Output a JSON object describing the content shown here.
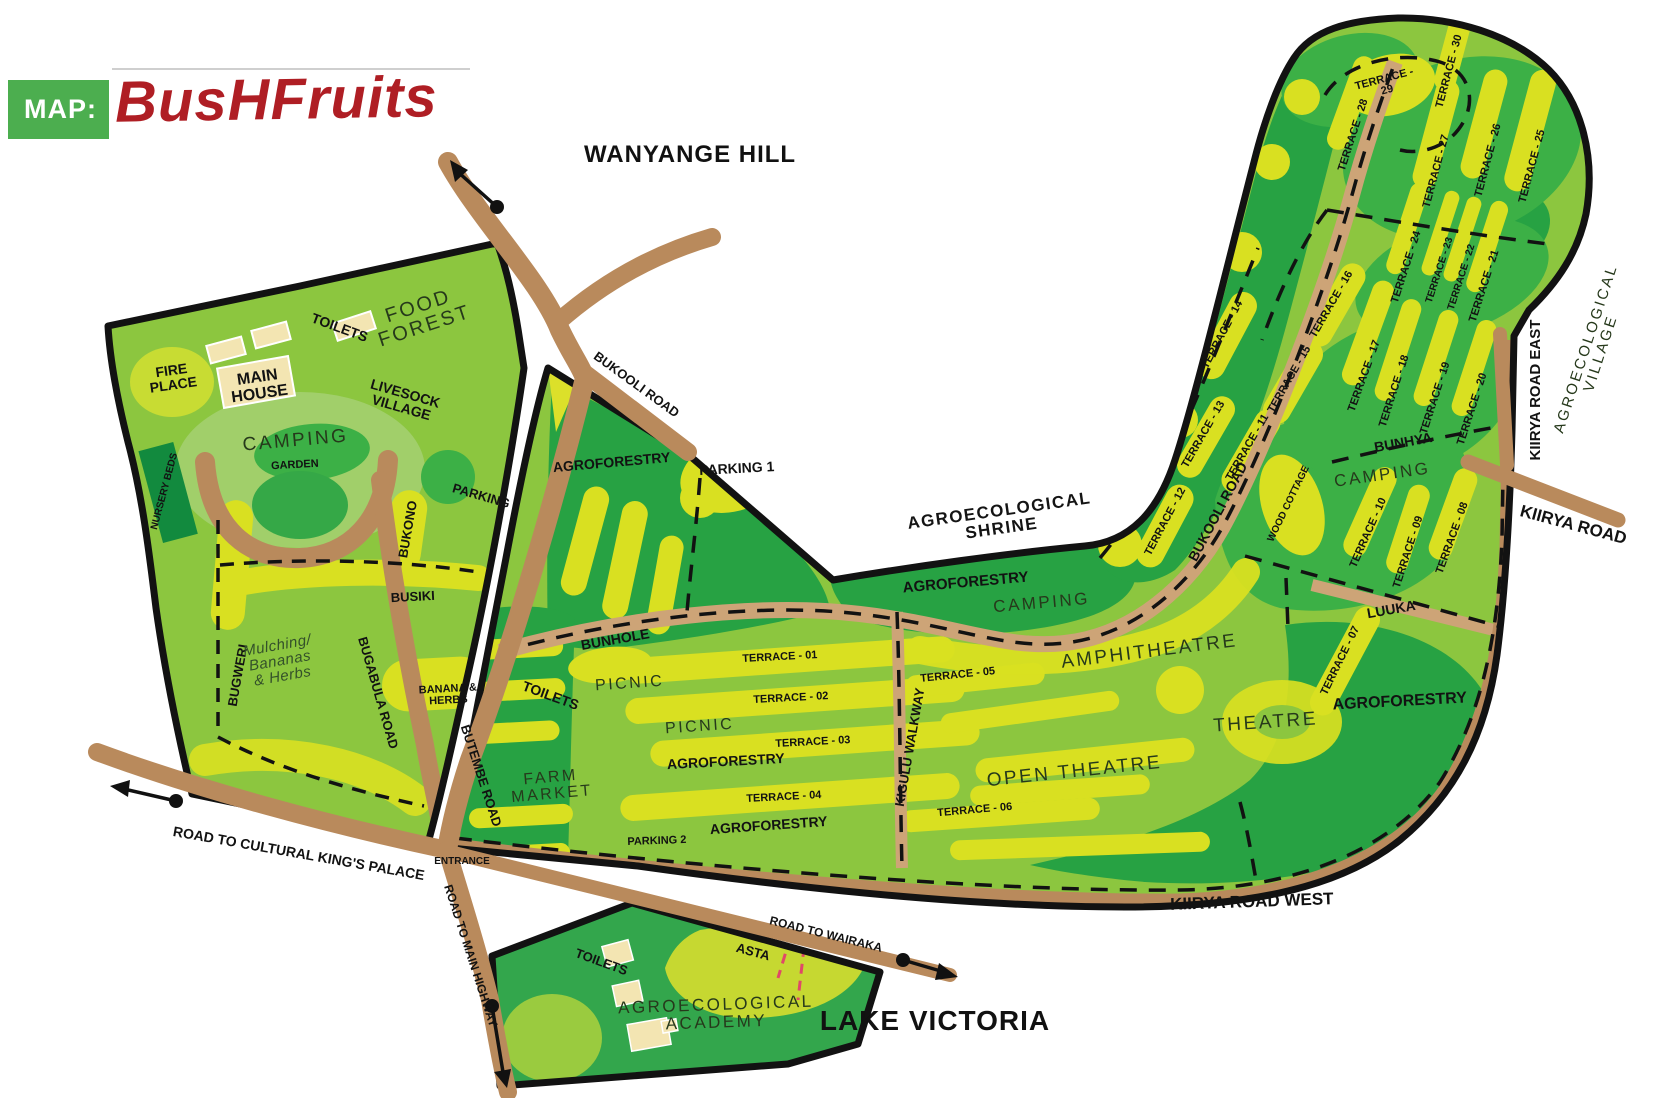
{
  "logo": {
    "map_prefix": "MAP:",
    "title": "BusHFruits"
  },
  "colors": {
    "logo_green": "#4CAE4F",
    "logo_red": "#AF1E24",
    "base_green": "#8CC63F",
    "mid_green": "#3CB046",
    "dark_green": "#27A243",
    "nursery_green": "#128A3E",
    "terrace_yellow": "#D9E021",
    "road_brown": "#B98A5C",
    "trail_tan": "#CDA477",
    "building_cream": "#F3E5B2",
    "outline_black": "#121212",
    "pink_dash": "#E04868"
  },
  "map": {
    "labels": [
      {
        "n": "wanyange-hill",
        "t": "WANYANGE HILL",
        "x": 690,
        "y": 162,
        "r": 0,
        "s": 24,
        "st": "head"
      },
      {
        "n": "lake-victoria",
        "t": "LAKE VICTORIA",
        "x": 935,
        "y": 1030,
        "r": 0,
        "s": 28,
        "st": "head"
      },
      {
        "n": "food-forest",
        "ls": [
          "FOOD",
          "FOREST"
        ],
        "x": 420,
        "y": 312,
        "r": -18,
        "s": 20,
        "st": "light"
      },
      {
        "n": "toilets-left",
        "t": "TOILETS",
        "x": 338,
        "y": 332,
        "r": 20,
        "s": 14,
        "st": "bold"
      },
      {
        "n": "fire-place",
        "ls": [
          "FIRE",
          "PLACE"
        ],
        "x": 172,
        "y": 375,
        "r": -8,
        "s": 14,
        "st": "bold"
      },
      {
        "n": "main-house",
        "ls": [
          "MAIN",
          "HOUSE"
        ],
        "x": 258,
        "y": 382,
        "r": -8,
        "s": 16,
        "st": "bold"
      },
      {
        "n": "livesock-village",
        "ls": [
          "LIVESOCK",
          "VILLAGE"
        ],
        "x": 404,
        "y": 398,
        "r": 16,
        "s": 14,
        "st": "bold"
      },
      {
        "n": "camping-left",
        "t": "CAMPING",
        "x": 296,
        "y": 446,
        "r": -5,
        "s": 19,
        "st": "light"
      },
      {
        "n": "garden",
        "t": "GARDEN",
        "x": 295,
        "y": 468,
        "r": -3,
        "s": 11,
        "st": "bold"
      },
      {
        "n": "nursery-beds",
        "t": "NURSERY BEDS",
        "x": 167,
        "y": 492,
        "r": -75,
        "s": 10,
        "st": "bold"
      },
      {
        "n": "parking-left",
        "t": "PARKING",
        "x": 480,
        "y": 500,
        "r": 16,
        "s": 13,
        "st": "bold"
      },
      {
        "n": "bukono",
        "t": "BUKONO",
        "x": 412,
        "y": 530,
        "r": -80,
        "s": 13,
        "st": "bold"
      },
      {
        "n": "busiki",
        "t": "BUSIKI",
        "x": 413,
        "y": 601,
        "r": -3,
        "s": 13,
        "st": "bold"
      },
      {
        "n": "bugweri",
        "t": "BUGWERI",
        "x": 242,
        "y": 676,
        "r": -80,
        "s": 13,
        "st": "bold"
      },
      {
        "n": "mulching",
        "ls": [
          "Mulching/",
          "Bananas",
          "& Herbs"
        ],
        "x": 278,
        "y": 650,
        "r": -10,
        "s": 15,
        "st": "italic"
      },
      {
        "n": "bugabula-road",
        "t": "BUGABULA ROAD",
        "x": 374,
        "y": 694,
        "r": 74,
        "s": 13,
        "st": "bold"
      },
      {
        "n": "banana-herbs",
        "ls": [
          "BANANA &",
          "HERBS"
        ],
        "x": 448,
        "y": 692,
        "r": -3,
        "s": 11,
        "st": "bold"
      },
      {
        "n": "butembe-road",
        "t": "BUTEMBE ROAD",
        "x": 477,
        "y": 777,
        "r": 72,
        "s": 13,
        "st": "bold"
      },
      {
        "n": "road-kings-palace",
        "t": "ROAD TO CULTURAL KING'S PALACE",
        "x": 298,
        "y": 858,
        "r": 10,
        "s": 14,
        "st": "bold"
      },
      {
        "n": "entrance",
        "t": "ENTRANCE",
        "x": 462,
        "y": 864,
        "r": 0,
        "s": 10,
        "st": "bold"
      },
      {
        "n": "road-main-highway",
        "t": "ROAD TO MAIN HIGHWAY",
        "x": 467,
        "y": 957,
        "r": 72,
        "s": 12,
        "st": "bold"
      },
      {
        "n": "bukooli-road-top",
        "t": "BUKOOLI ROAD",
        "x": 634,
        "y": 388,
        "r": 36,
        "s": 13,
        "st": "bold"
      },
      {
        "n": "agroforestry-nw",
        "t": "AGROFORESTRY",
        "x": 612,
        "y": 467,
        "r": -5,
        "s": 14,
        "st": "bold"
      },
      {
        "n": "parking-1",
        "t": "PARKING 1",
        "x": 737,
        "y": 473,
        "r": -3,
        "s": 14,
        "st": "bold"
      },
      {
        "n": "agro-shrine",
        "ls": [
          "AGROECOLOGICAL",
          "SHRINE"
        ],
        "x": 1000,
        "y": 516,
        "r": -8,
        "s": 17,
        "st": "med"
      },
      {
        "n": "agroforestry-shrine",
        "t": "AGROFORESTRY",
        "x": 966,
        "y": 587,
        "r": -5,
        "s": 15,
        "st": "bold"
      },
      {
        "n": "camping-mid",
        "t": "CAMPING",
        "x": 1042,
        "y": 608,
        "r": -5,
        "s": 17,
        "st": "light"
      },
      {
        "n": "amphitheatre",
        "t": "AMPHITHEATRE",
        "x": 1150,
        "y": 657,
        "r": -7,
        "s": 19,
        "st": "light"
      },
      {
        "n": "bunhole",
        "t": "BUNHOLE",
        "x": 616,
        "y": 644,
        "r": -10,
        "s": 14,
        "st": "bold"
      },
      {
        "n": "toilets-mid",
        "t": "TOILETS",
        "x": 549,
        "y": 700,
        "r": 20,
        "s": 14,
        "st": "bold"
      },
      {
        "n": "picnic-upper",
        "t": "PICNIC",
        "x": 630,
        "y": 688,
        "r": -4,
        "s": 16,
        "st": "light"
      },
      {
        "n": "terrace-01",
        "t": "TERRACE - 01",
        "x": 780,
        "y": 660,
        "r": -3,
        "s": 11,
        "st": "bold"
      },
      {
        "n": "terrace-02",
        "t": "TERRACE - 02",
        "x": 791,
        "y": 701,
        "r": -3,
        "s": 11,
        "st": "bold"
      },
      {
        "n": "picnic-lower",
        "t": "PICNIC",
        "x": 700,
        "y": 731,
        "r": -4,
        "s": 16,
        "st": "light"
      },
      {
        "n": "terrace-03",
        "t": "TERRACE - 03",
        "x": 813,
        "y": 745,
        "r": -3,
        "s": 11,
        "st": "bold"
      },
      {
        "n": "agroforestry-mid",
        "t": "AGROFORESTRY",
        "x": 726,
        "y": 766,
        "r": -3,
        "s": 14,
        "st": "bold"
      },
      {
        "n": "terrace-04",
        "t": "TERRACE - 04",
        "x": 784,
        "y": 800,
        "r": -3,
        "s": 11,
        "st": "bold"
      },
      {
        "n": "agroforestry-low",
        "t": "AGROFORESTRY",
        "x": 769,
        "y": 830,
        "r": -4,
        "s": 14,
        "st": "bold"
      },
      {
        "n": "parking-2",
        "t": "PARKING 2",
        "x": 657,
        "y": 844,
        "r": -2,
        "s": 11,
        "st": "bold"
      },
      {
        "n": "farm-market",
        "ls": [
          "FARM",
          "MARKET"
        ],
        "x": 551,
        "y": 782,
        "r": -5,
        "s": 16,
        "st": "light"
      },
      {
        "n": "kigulu-walkway",
        "t": "KIGULU WALKWAY",
        "x": 914,
        "y": 748,
        "r": -80,
        "s": 13,
        "st": "bold"
      },
      {
        "n": "terrace-05",
        "t": "TERRACE - 05",
        "x": 958,
        "y": 678,
        "r": -6,
        "s": 11,
        "st": "bold"
      },
      {
        "n": "terrace-06",
        "t": "TERRACE - 06",
        "x": 975,
        "y": 813,
        "r": -5,
        "s": 11,
        "st": "bold"
      },
      {
        "n": "open-theatre",
        "t": "OPEN THEATRE",
        "x": 1075,
        "y": 777,
        "r": -6,
        "s": 19,
        "st": "light"
      },
      {
        "n": "theatre",
        "t": "THEATRE",
        "x": 1266,
        "y": 728,
        "r": -4,
        "s": 19,
        "st": "light"
      },
      {
        "n": "agroforestry-right",
        "t": "AGROFORESTRY",
        "x": 1400,
        "y": 706,
        "r": -3,
        "s": 16,
        "st": "bold"
      },
      {
        "n": "terrace-07",
        "t": "TERRACE - 07",
        "x": 1343,
        "y": 662,
        "r": -64,
        "s": 11,
        "st": "bold"
      },
      {
        "n": "luuka",
        "t": "LUUKA",
        "x": 1392,
        "y": 614,
        "r": -10,
        "s": 14,
        "st": "bold"
      },
      {
        "n": "terrace-08",
        "t": "TERRACE - 08",
        "x": 1455,
        "y": 539,
        "r": -70,
        "s": 11,
        "st": "bold"
      },
      {
        "n": "terrace-09",
        "t": "TERRACE - 09",
        "x": 1411,
        "y": 553,
        "r": -72,
        "s": 11,
        "st": "bold"
      },
      {
        "n": "terrace-10",
        "t": "TERRACE - 10",
        "x": 1371,
        "y": 534,
        "r": -66,
        "s": 11,
        "st": "bold"
      },
      {
        "n": "wood-cottage",
        "t": "WOOD COTTAGE",
        "x": 1291,
        "y": 505,
        "r": -64,
        "s": 10,
        "st": "bold"
      },
      {
        "n": "camping-right",
        "t": "CAMPING",
        "x": 1383,
        "y": 480,
        "r": -8,
        "s": 17,
        "st": "light"
      },
      {
        "n": "bunhya",
        "t": "BUNHYA",
        "x": 1404,
        "y": 447,
        "r": -10,
        "s": 14,
        "st": "bold"
      },
      {
        "n": "terrace-11",
        "t": "TERRACE - 11",
        "x": 1250,
        "y": 449,
        "r": -60,
        "s": 11,
        "st": "bold"
      },
      {
        "n": "bukooli-road-right",
        "t": "BUKOOLI ROAD",
        "x": 1222,
        "y": 514,
        "r": -62,
        "s": 14,
        "st": "bold"
      },
      {
        "n": "terrace-12",
        "t": "TERRACE - 12",
        "x": 1168,
        "y": 523,
        "r": -62,
        "s": 11,
        "st": "bold"
      },
      {
        "n": "terrace-13",
        "t": "TERRACE - 13",
        "x": 1206,
        "y": 436,
        "r": -60,
        "s": 11,
        "st": "bold"
      },
      {
        "n": "terrace-14",
        "t": "TERRACE - 14",
        "x": 1225,
        "y": 336,
        "r": -62,
        "s": 11,
        "st": "bold"
      },
      {
        "n": "terrace-15",
        "t": "TERRACE - 15",
        "x": 1292,
        "y": 381,
        "r": -60,
        "s": 11,
        "st": "bold"
      },
      {
        "n": "terrace-16",
        "t": "TERRACE - 16",
        "x": 1334,
        "y": 306,
        "r": -60,
        "s": 11,
        "st": "bold"
      },
      {
        "n": "terrace-17",
        "t": "TERRACE - 17",
        "x": 1367,
        "y": 377,
        "r": -70,
        "s": 11,
        "st": "bold"
      },
      {
        "n": "terrace-18",
        "t": "TERRACE - 18",
        "x": 1397,
        "y": 392,
        "r": -72,
        "s": 11,
        "st": "bold"
      },
      {
        "n": "terrace-19",
        "t": "TERRACE - 19",
        "x": 1438,
        "y": 399,
        "r": -72,
        "s": 11,
        "st": "bold"
      },
      {
        "n": "terrace-20",
        "t": "TERRACE - 20",
        "x": 1475,
        "y": 410,
        "r": -72,
        "s": 11,
        "st": "bold"
      },
      {
        "n": "terrace-21",
        "t": "TERRACE - 21",
        "x": 1487,
        "y": 287,
        "r": -72,
        "s": 11,
        "st": "bold"
      },
      {
        "n": "terrace-22",
        "t": "TERRACE - 22",
        "x": 1464,
        "y": 278,
        "r": -72,
        "s": 10,
        "st": "bold"
      },
      {
        "n": "terrace-23",
        "t": "TERRACE - 23",
        "x": 1442,
        "y": 271,
        "r": -72,
        "s": 10,
        "st": "bold"
      },
      {
        "n": "terrace-24",
        "t": "TERRACE - 24",
        "x": 1409,
        "y": 268,
        "r": -72,
        "s": 11,
        "st": "bold"
      },
      {
        "n": "terrace-25",
        "t": "TERRACE - 25",
        "x": 1535,
        "y": 167,
        "r": -75,
        "s": 11,
        "st": "bold"
      },
      {
        "n": "terrace-26",
        "t": "TERRACE - 26",
        "x": 1491,
        "y": 161,
        "r": -75,
        "s": 11,
        "st": "bold"
      },
      {
        "n": "terrace-27",
        "t": "TERRACE - 27",
        "x": 1439,
        "y": 172,
        "r": -75,
        "s": 11,
        "st": "bold"
      },
      {
        "n": "terrace-28",
        "t": "TERRACE - 28",
        "x": 1356,
        "y": 136,
        "r": -72,
        "s": 11,
        "st": "bold"
      },
      {
        "n": "terrace-29",
        "ls": [
          "TERRACE -",
          "29"
        ],
        "x": 1385,
        "y": 82,
        "r": -15,
        "s": 11,
        "st": "bold"
      },
      {
        "n": "terrace-30",
        "t": "TERRACE - 30",
        "x": 1452,
        "y": 72,
        "r": -75,
        "s": 11,
        "st": "bold"
      },
      {
        "n": "kiirya-road-east",
        "t": "KIIRYA ROAD EAST",
        "x": 1540,
        "y": 390,
        "r": -90,
        "s": 15,
        "st": "bold"
      },
      {
        "n": "agro-village",
        "ls": [
          "AGROECOLOGICAL",
          "VILLAGE"
        ],
        "x": 1590,
        "y": 350,
        "r": -72,
        "s": 15,
        "st": "light"
      },
      {
        "n": "kiirya-road",
        "t": "KIIRYA ROAD",
        "x": 1572,
        "y": 530,
        "r": 15,
        "s": 17,
        "st": "bold"
      },
      {
        "n": "kiirya-road-west",
        "t": "KIIRYA ROAD WEST",
        "x": 1252,
        "y": 907,
        "r": -2,
        "s": 17,
        "st": "bold"
      },
      {
        "n": "road-wairaka",
        "t": "ROAD TO WAIRAKA",
        "x": 825,
        "y": 938,
        "r": 14,
        "s": 12,
        "st": "bold"
      },
      {
        "n": "asta",
        "t": "ASTA",
        "x": 752,
        "y": 956,
        "r": 15,
        "s": 13,
        "st": "bold"
      },
      {
        "n": "toilets-academy",
        "t": "TOILETS",
        "x": 600,
        "y": 966,
        "r": 20,
        "s": 13,
        "st": "bold"
      },
      {
        "n": "agro-academy",
        "ls": [
          "AGROECOLOGICAL",
          "ACADEMY"
        ],
        "x": 716,
        "y": 1010,
        "r": -2,
        "s": 17,
        "st": "light"
      }
    ]
  }
}
